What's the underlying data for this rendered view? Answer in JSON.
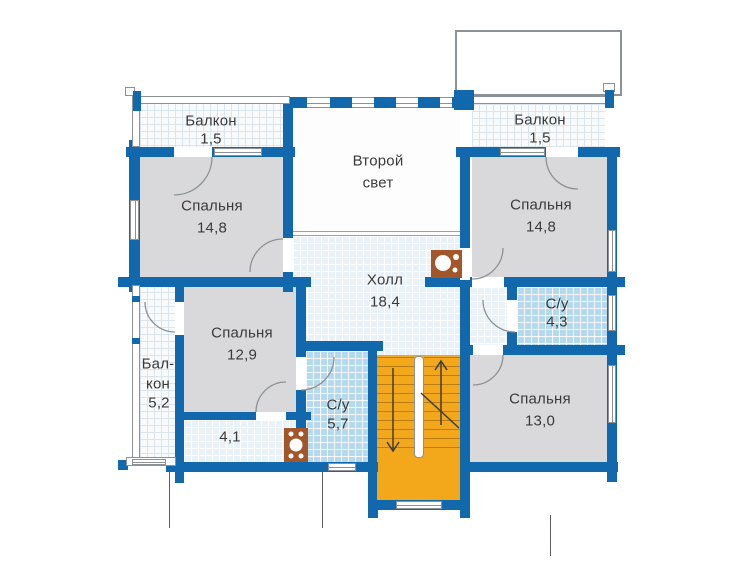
{
  "plan_type": "floor-plan",
  "language": "ru",
  "rooms": {
    "balcony_top_left": {
      "name": "Балкон",
      "area": "1,5"
    },
    "bedroom_top_left": {
      "name": "Спальня",
      "area": "14,8"
    },
    "second_light": {
      "name_line1": "Второй",
      "name_line2": "свет"
    },
    "balcony_top_right": {
      "name": "Балкон",
      "area": "1,5"
    },
    "bedroom_top_right": {
      "name": "Спальня",
      "area": "14,8"
    },
    "hall": {
      "name": "Холл",
      "area": "18,4"
    },
    "bedroom_mid_left": {
      "name": "Спальня",
      "area": "12,9"
    },
    "bathroom_small": {
      "name": "С/у",
      "area": "4,3"
    },
    "balcony_left": {
      "name_line1": "Бал-",
      "name_line2": "кон",
      "area": "5,2"
    },
    "storage": {
      "area": "4,1"
    },
    "bathroom_large": {
      "name": "С/у",
      "area": "5,7"
    },
    "bedroom_bottom_right": {
      "name": "Спальня",
      "area": "13,0"
    }
  },
  "colors": {
    "wall": "#1168ac",
    "room_fill": "#d9d9dc",
    "hall_floor": "#e9f1f9",
    "balcony_floor": "#f8fafc",
    "balcony_grid": "#dbe5ee",
    "bathroom_floor": "#b7d9ee",
    "stairs": "#f3a81c",
    "fireplace": "#a2562a",
    "outline": "#8c9196",
    "text": "#3a3a3c"
  }
}
